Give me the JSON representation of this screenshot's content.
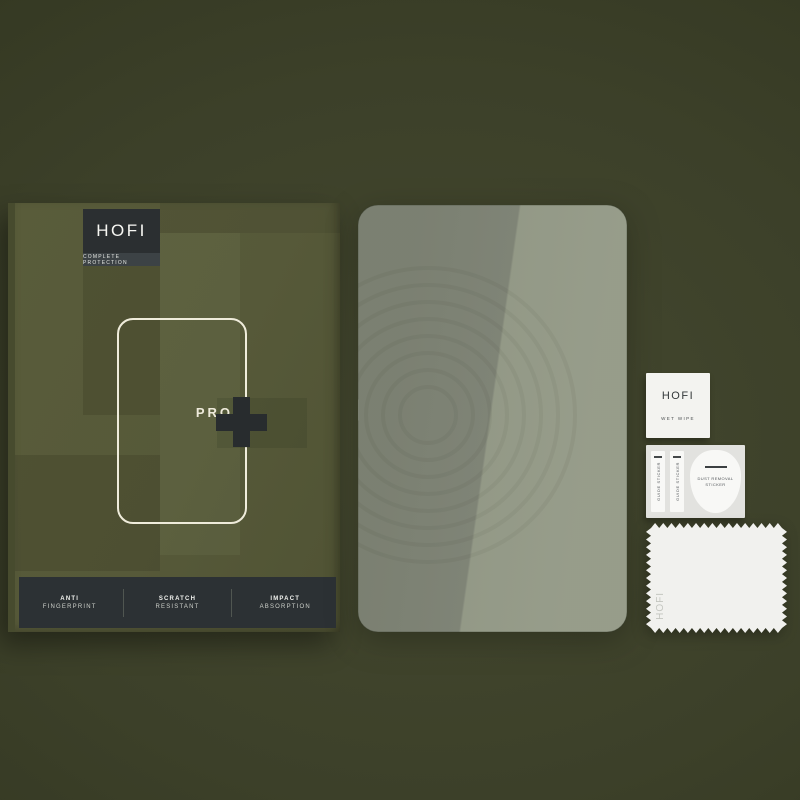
{
  "product": {
    "brand": "HOFI",
    "tagline": "COMPLETE PROTECTION",
    "model_line": "PRO",
    "plus_mark": "+",
    "features": [
      {
        "line1": "ANTI",
        "line2": "FINGERPRINT"
      },
      {
        "line1": "SCRATCH",
        "line2": "RESISTANT"
      },
      {
        "line1": "IMPACT",
        "line2": "ABSORPTION"
      }
    ]
  },
  "accessories": {
    "wet_wipe": {
      "brand": "HOFI",
      "label": "WET WIPE"
    },
    "guide_sticker": {
      "label": "GUIDE STICKER"
    },
    "dust_removal": {
      "label": "DUST REMOVAL STICKER"
    },
    "cloth": {
      "brand": "HOFI"
    }
  },
  "colors": {
    "background": "#3c4029",
    "box_face": "#575a38",
    "box_dark_panel": "#2c3134",
    "glass_tint_left": "#7e8375",
    "glass_tint_right": "#9aa18f",
    "outline_cream": "#efecdb",
    "paper_white": "#f3f3f0"
  }
}
